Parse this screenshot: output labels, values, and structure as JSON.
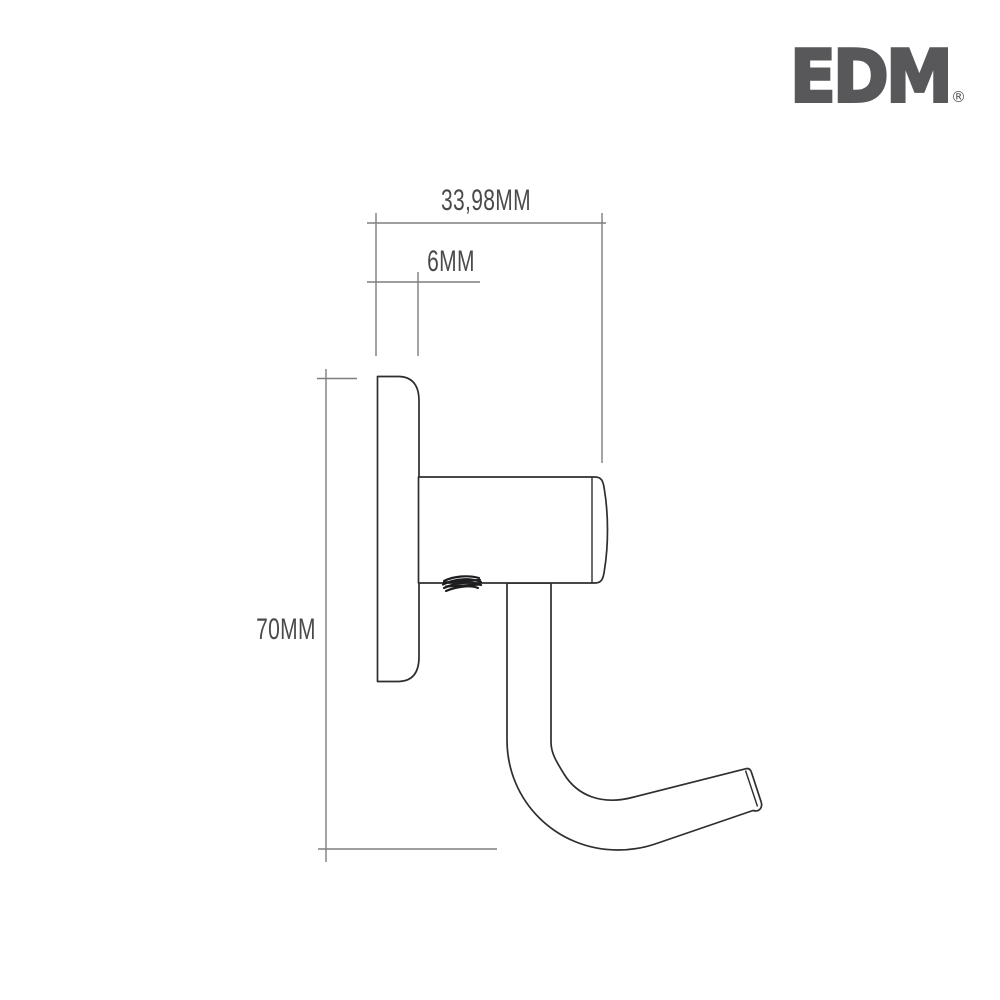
{
  "brand": {
    "logo_text": "EDM",
    "registered_mark": "®",
    "logo_color": "#58585a"
  },
  "drawing": {
    "subject": "wall-hook-side-view-technical-drawing",
    "colors": {
      "outline": "#2e2e30",
      "dimension_lines": "#7e7e81",
      "label_text": "#4a4a4c",
      "background": "#ffffff"
    },
    "dimensions": {
      "width": "33,98MM",
      "plate_thickness": "6MM",
      "height": "70MM"
    }
  }
}
